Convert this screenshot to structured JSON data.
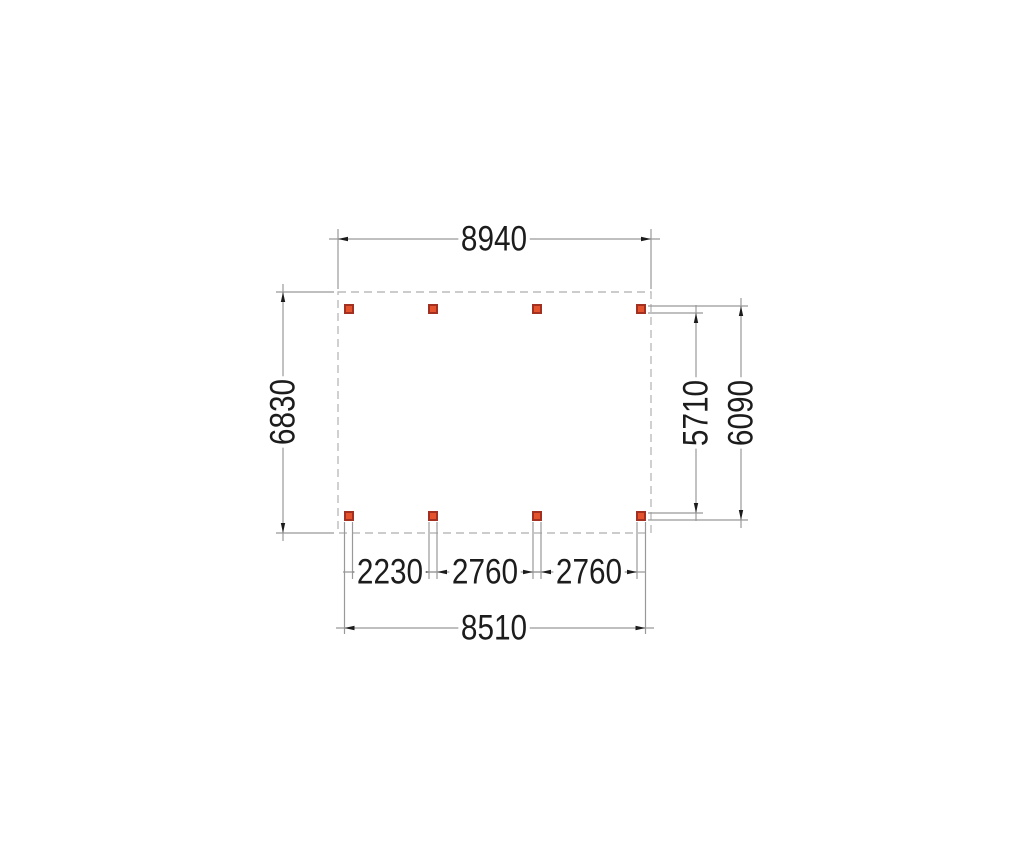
{
  "drawing": {
    "type": "plan-view-dimension-drawing",
    "dimensions": {
      "top_width": "8940",
      "left_height": "6830",
      "right_inner_height": "5710",
      "right_outer_height": "6090",
      "bottom_spacing_1": "2230",
      "bottom_spacing_2": "2760",
      "bottom_spacing_3": "2760",
      "bottom_width": "8510"
    },
    "posts": {
      "count": 8,
      "rows": 2,
      "columns": 4,
      "fill_color": "#e2532e",
      "border_color": "#a33121"
    },
    "colors": {
      "outline_dashed": "#bcbcbc",
      "dimension_lines": "#999999",
      "text": "#1c1c1c"
    }
  }
}
